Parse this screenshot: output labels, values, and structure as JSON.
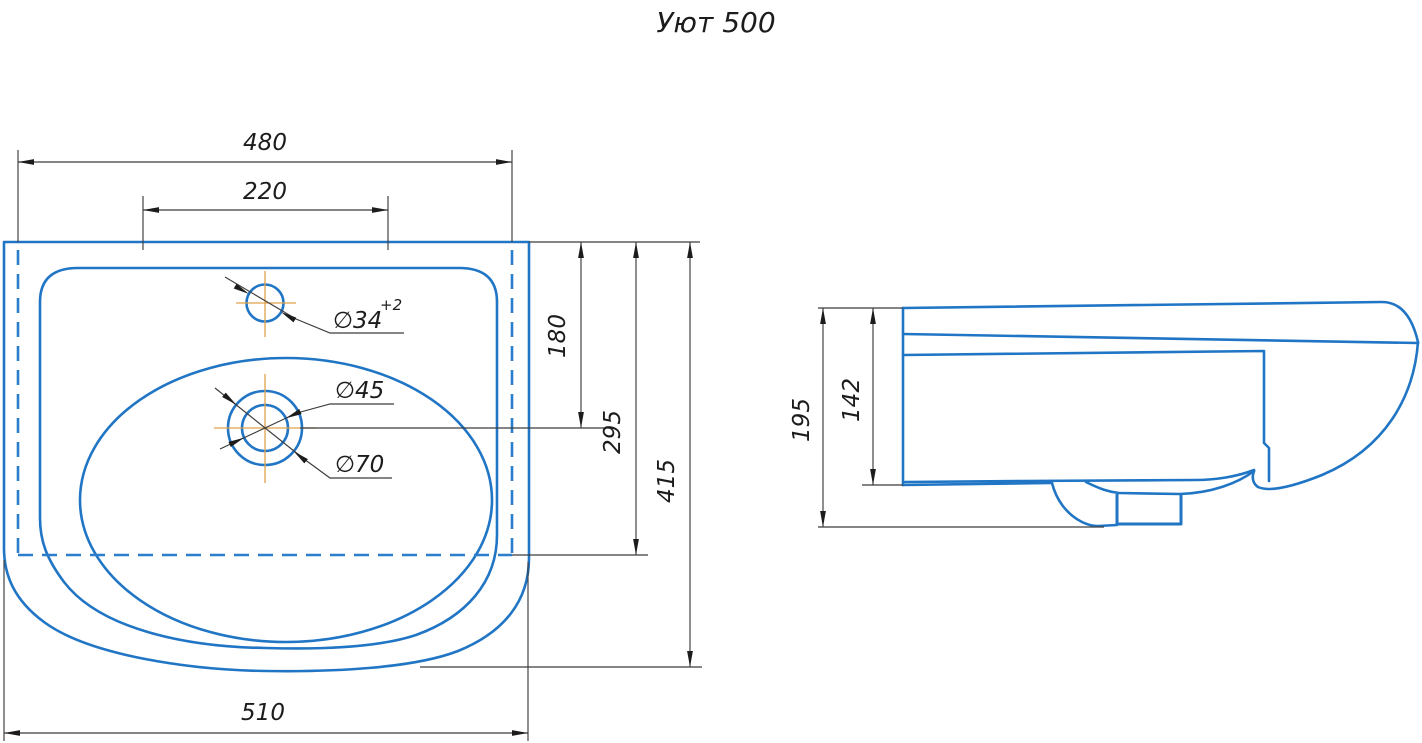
{
  "title": "Уют 500",
  "drawing": {
    "type": "technical-drawing",
    "views": [
      "plan-view",
      "side-view"
    ]
  },
  "dimensions": {
    "width_top": "480",
    "hole_spacing": "220",
    "depth_to_drain": "180",
    "depth_mid": "295",
    "depth_total": "415",
    "width_bottom": "510",
    "height_total": "195",
    "height_body": "142",
    "faucet_hole_dia": "∅34",
    "faucet_hole_tol": "+2",
    "drain_dia_inner": "∅45",
    "drain_dia_outer": "∅70"
  },
  "colors": {
    "outline_blue": "#2075c5",
    "centerline_orange": "#e0a14a",
    "dimension_gray": "#3c3c3c",
    "text_black": "#1c1c1c",
    "background": "#ffffff"
  }
}
